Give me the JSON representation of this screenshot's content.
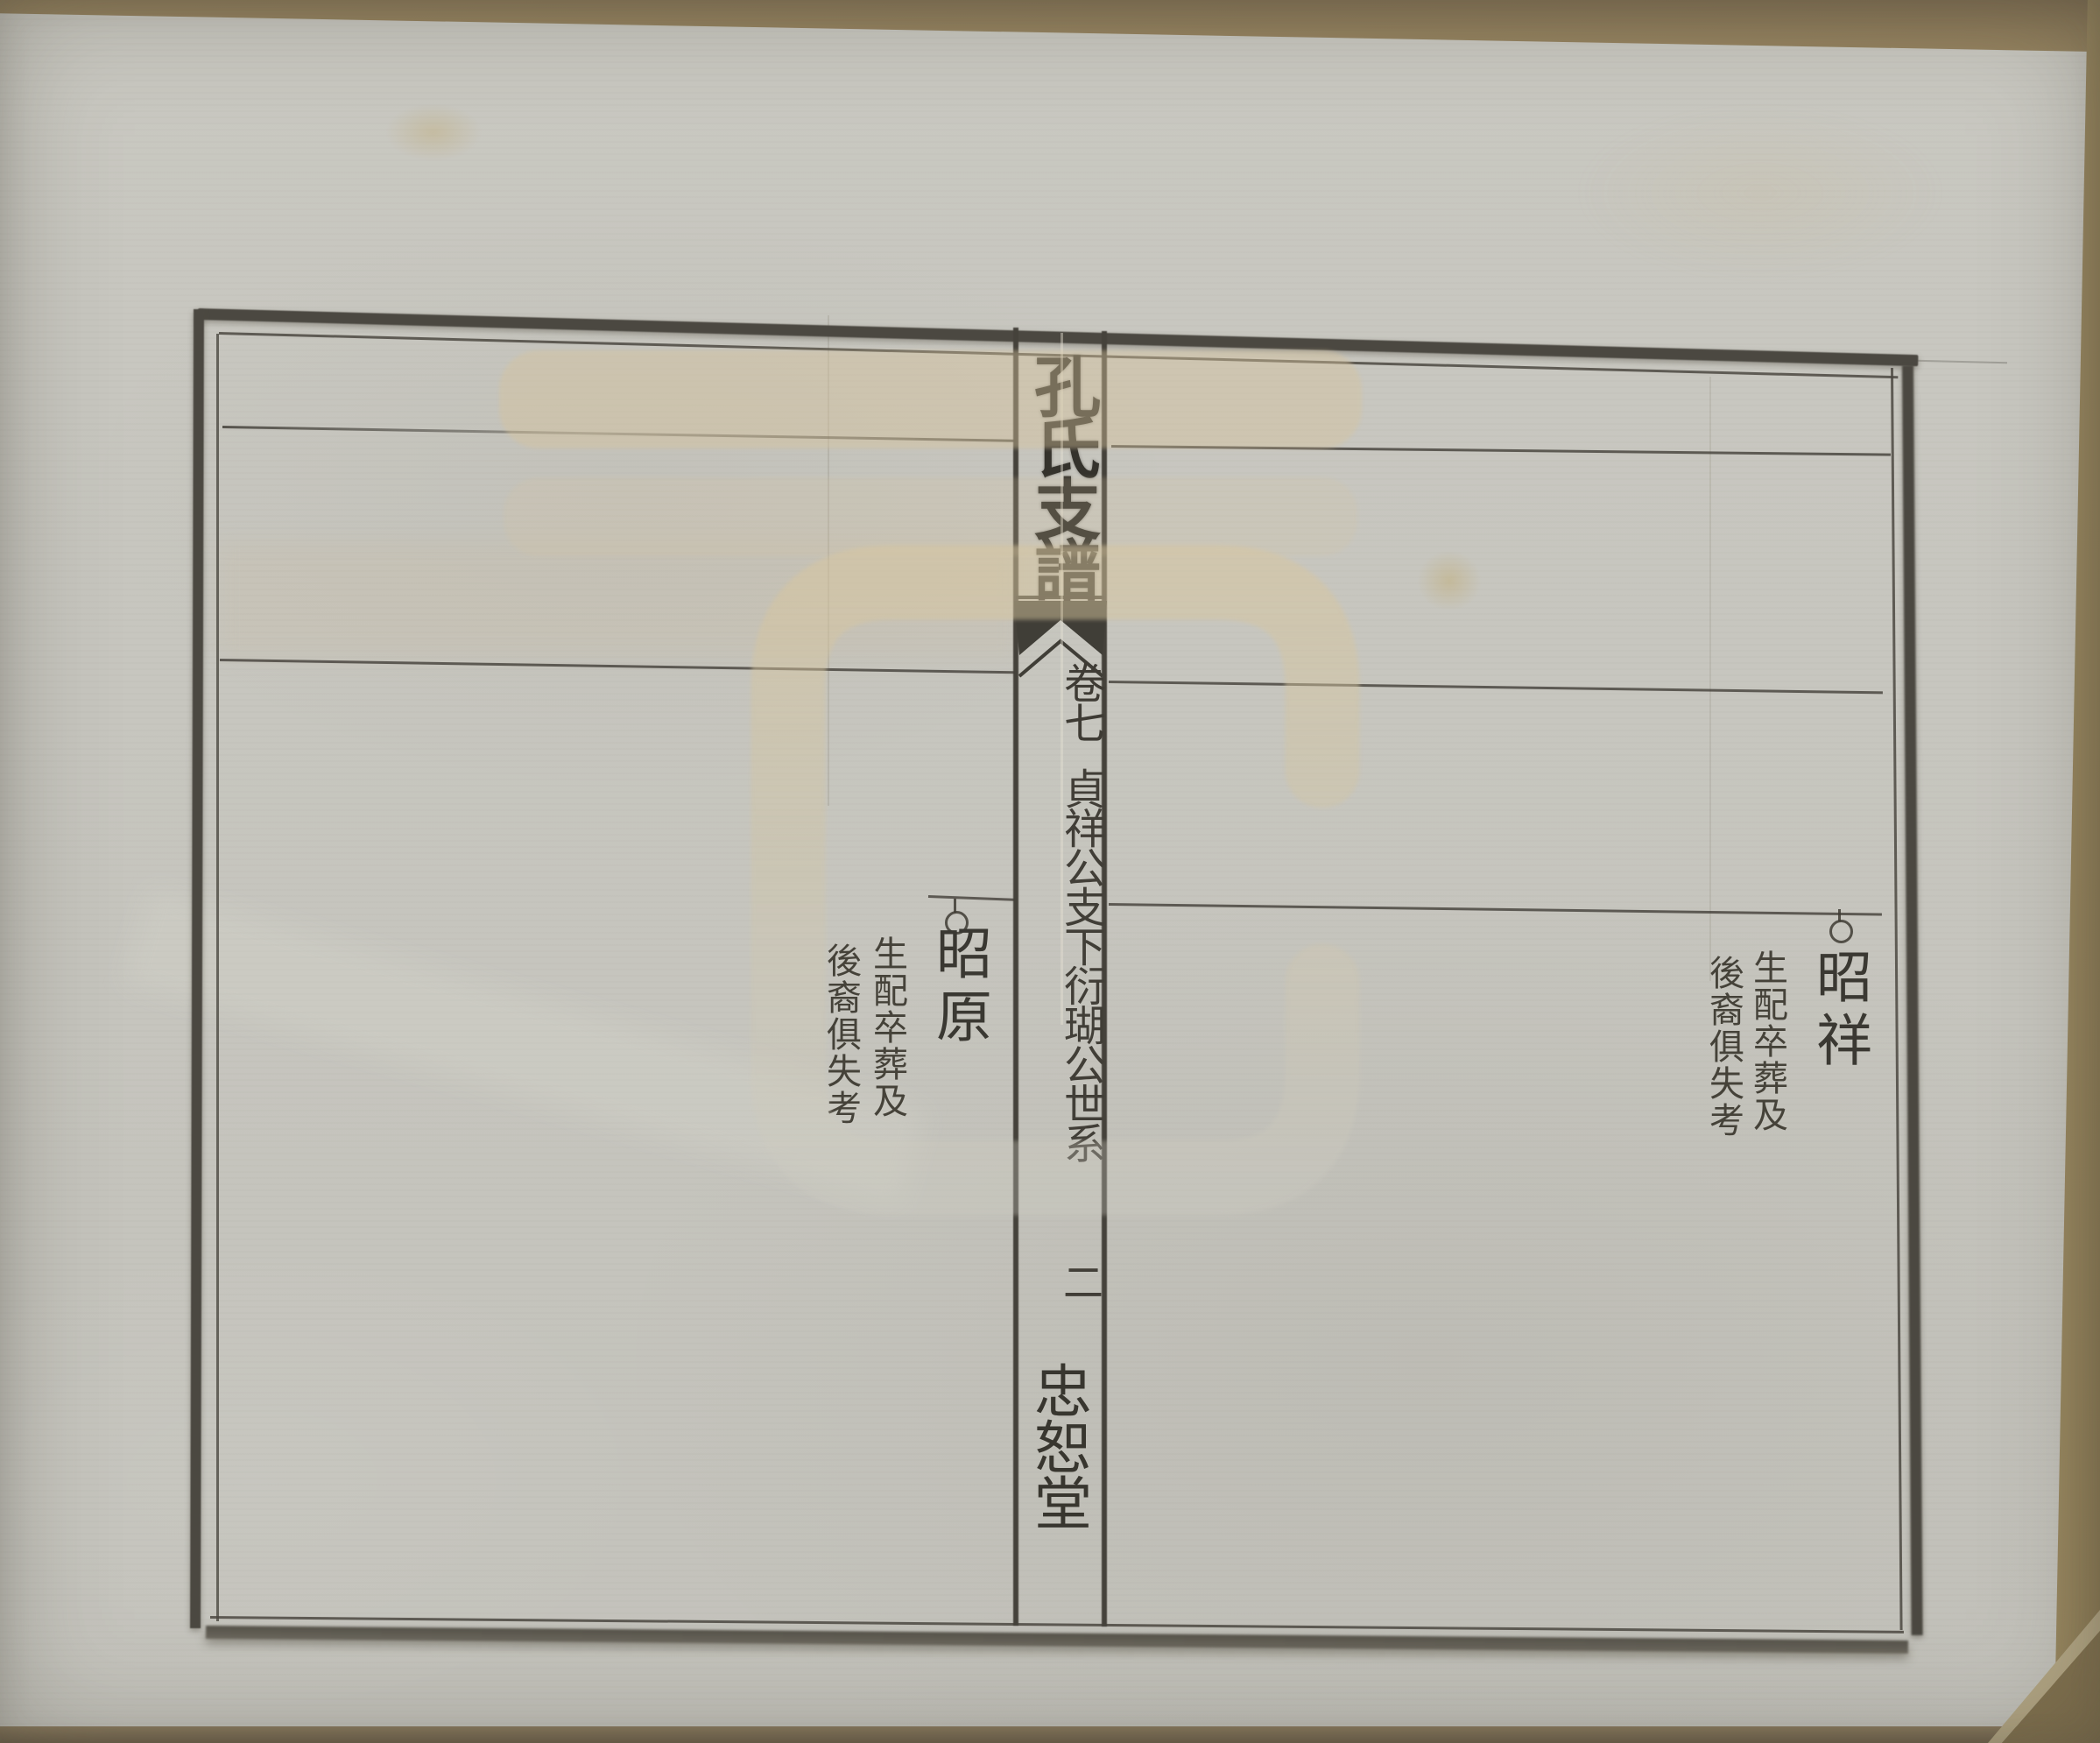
{
  "center_column": {
    "title": "孔氏支譜",
    "volume": "卷七",
    "section_title": "貞祥公支下衍瑚公世系",
    "page_number": "二",
    "hall_name": "忠恕堂"
  },
  "entries": {
    "left": {
      "name": "昭原",
      "note_col_1": "生配卒葬及",
      "note_col_2": "後裔俱失考"
    },
    "right": {
      "name": "昭祥",
      "note_col_1": "生配卒葬及",
      "note_col_2": "後裔俱失考"
    }
  },
  "colors": {
    "ink": "#4b4841",
    "title_ink": "#34322c",
    "paper": "#c6c5be",
    "watermark_tan": "#d6c39c",
    "watermark_gray": "#c9c6bc",
    "backing_brown": "#8d7c60"
  }
}
